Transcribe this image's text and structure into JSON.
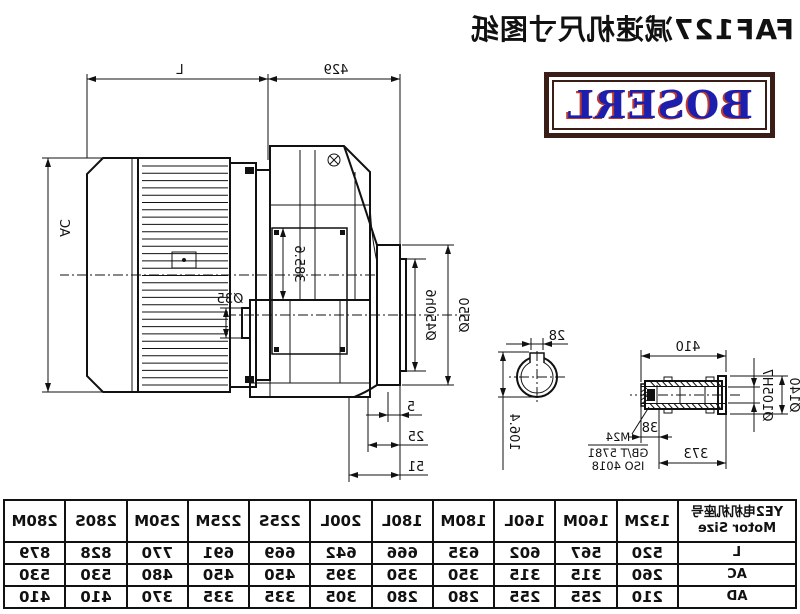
{
  "title": "FAF127减速机尺寸图纸",
  "logo": {
    "text": "BOSERL"
  },
  "colors": {
    "line": "#111111",
    "logo_border": "#3a1d16",
    "logo_text": "#1c1fae",
    "logo_shadow": "#c0392b",
    "background": "#ffffff"
  },
  "drawing": {
    "dims": {
      "motor_length": "L",
      "gearbox_length": "429",
      "motor_diameter": "AC",
      "center_height": "385.6",
      "flange_od": "Ø550",
      "flange_spigot": "Ø450h6",
      "rear_cap": "Ø35",
      "step1": "5",
      "step2": "25",
      "step3": "51"
    },
    "shaft_detail": {
      "keyway_width": "28",
      "keyway_height": "106.4",
      "total_length": "410",
      "body_length": "373",
      "thread_length": "38",
      "shaft_od": "Ø140",
      "bore": "Ø105H7",
      "bolt": "M24",
      "bolt_std1": "GB/T 5781",
      "bolt_std2": "ISO 4018"
    }
  },
  "table": {
    "header": {
      "line1": "YE2电机机座号",
      "line2": "Motor Size"
    },
    "columns": [
      "132M",
      "160M",
      "160L",
      "180M",
      "180L",
      "200L",
      "225S",
      "225M",
      "250M",
      "280S",
      "280M"
    ],
    "rows": [
      {
        "label": "L",
        "values": [
          "520",
          "567",
          "602",
          "635",
          "666",
          "642",
          "669",
          "691",
          "770",
          "828",
          "879"
        ]
      },
      {
        "label": "AC",
        "values": [
          "260",
          "315",
          "315",
          "350",
          "350",
          "395",
          "450",
          "450",
          "480",
          "530",
          "530"
        ]
      },
      {
        "label": "AD",
        "values": [
          "210",
          "255",
          "255",
          "280",
          "280",
          "305",
          "335",
          "335",
          "370",
          "410",
          "410"
        ]
      }
    ]
  }
}
